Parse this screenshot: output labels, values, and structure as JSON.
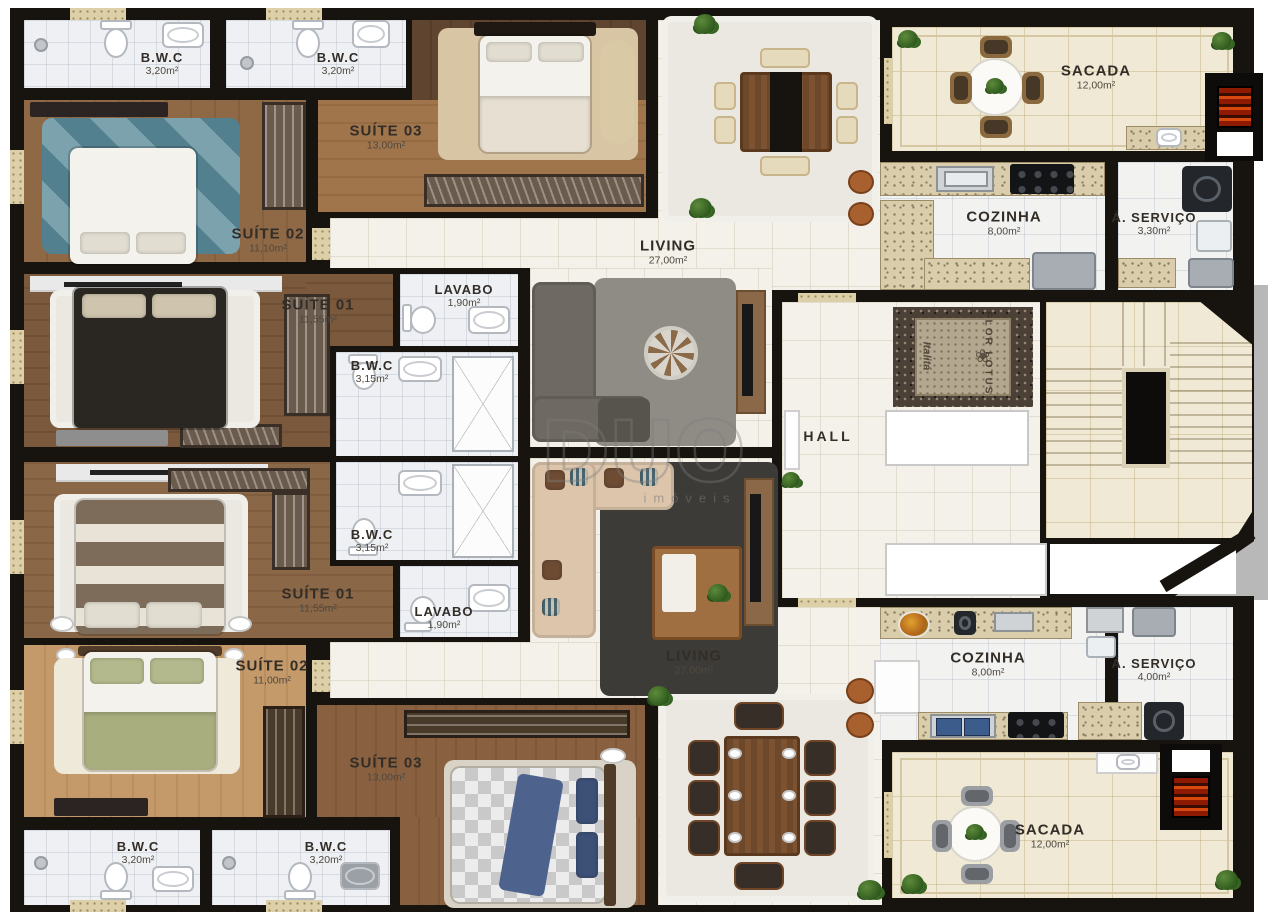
{
  "plan": {
    "watermark": {
      "brand": "DUO",
      "tagline": "imóveis"
    },
    "floor_decor": {
      "line1": "FLOR LOTUS",
      "line2": "Italitá",
      "lotus_glyph": "❀"
    },
    "rooms": {
      "t_bwc1": {
        "name": "B.W.C",
        "area": "3,20m²"
      },
      "t_bwc2": {
        "name": "B.W.C",
        "area": "3,20m²"
      },
      "t_s03": {
        "name": "SUÍTE 03",
        "area": "13,00m²"
      },
      "t_s02": {
        "name": "SUÍTE 02",
        "area": "11,10m²"
      },
      "t_s01": {
        "name": "SUÍTE 01",
        "area": "11,55m²"
      },
      "t_lavabo": {
        "name": "LAVABO",
        "area": "1,90m²"
      },
      "t_bwc3": {
        "name": "B.W.C",
        "area": "3,15m²"
      },
      "t_liv": {
        "name": "LIVING",
        "area": "27,00m²"
      },
      "t_coz": {
        "name": "COZINHA",
        "area": "8,00m²"
      },
      "t_ser": {
        "name": "Á. SERVIÇO",
        "area": "3,30m²"
      },
      "t_sac": {
        "name": "SACADA",
        "area": "12,00m²"
      },
      "hall": {
        "name": "HALL"
      },
      "b_bwc3": {
        "name": "B.W.C",
        "area": "3,15m²"
      },
      "b_s01": {
        "name": "SUÍTE 01",
        "area": "11,55m²"
      },
      "b_lavabo": {
        "name": "LAVABO",
        "area": "1,90m²"
      },
      "b_s02": {
        "name": "SUÍTE 02",
        "area": "11,00m²"
      },
      "b_s03": {
        "name": "SUÍTE 03",
        "area": "13,00m²"
      },
      "b_liv": {
        "name": "LIVING",
        "area": "27,00m²"
      },
      "b_coz": {
        "name": "COZINHA",
        "area": "8,00m²"
      },
      "b_ser": {
        "name": "Á. SERVIÇO",
        "area": "4,00m²"
      },
      "b_sac": {
        "name": "SACADA",
        "area": "12,00m²"
      },
      "b_bwc1": {
        "name": "B.W.C",
        "area": "3,20m²"
      },
      "b_bwc2": {
        "name": "B.W.C",
        "area": "3,20m²"
      }
    },
    "colors": {
      "wall": "#17130e",
      "bath_tile": "#eef0f3",
      "balcony_tile": "#f0e9d6",
      "grill_red": "#c8400c",
      "wood_mid": "#8a6342"
    }
  }
}
